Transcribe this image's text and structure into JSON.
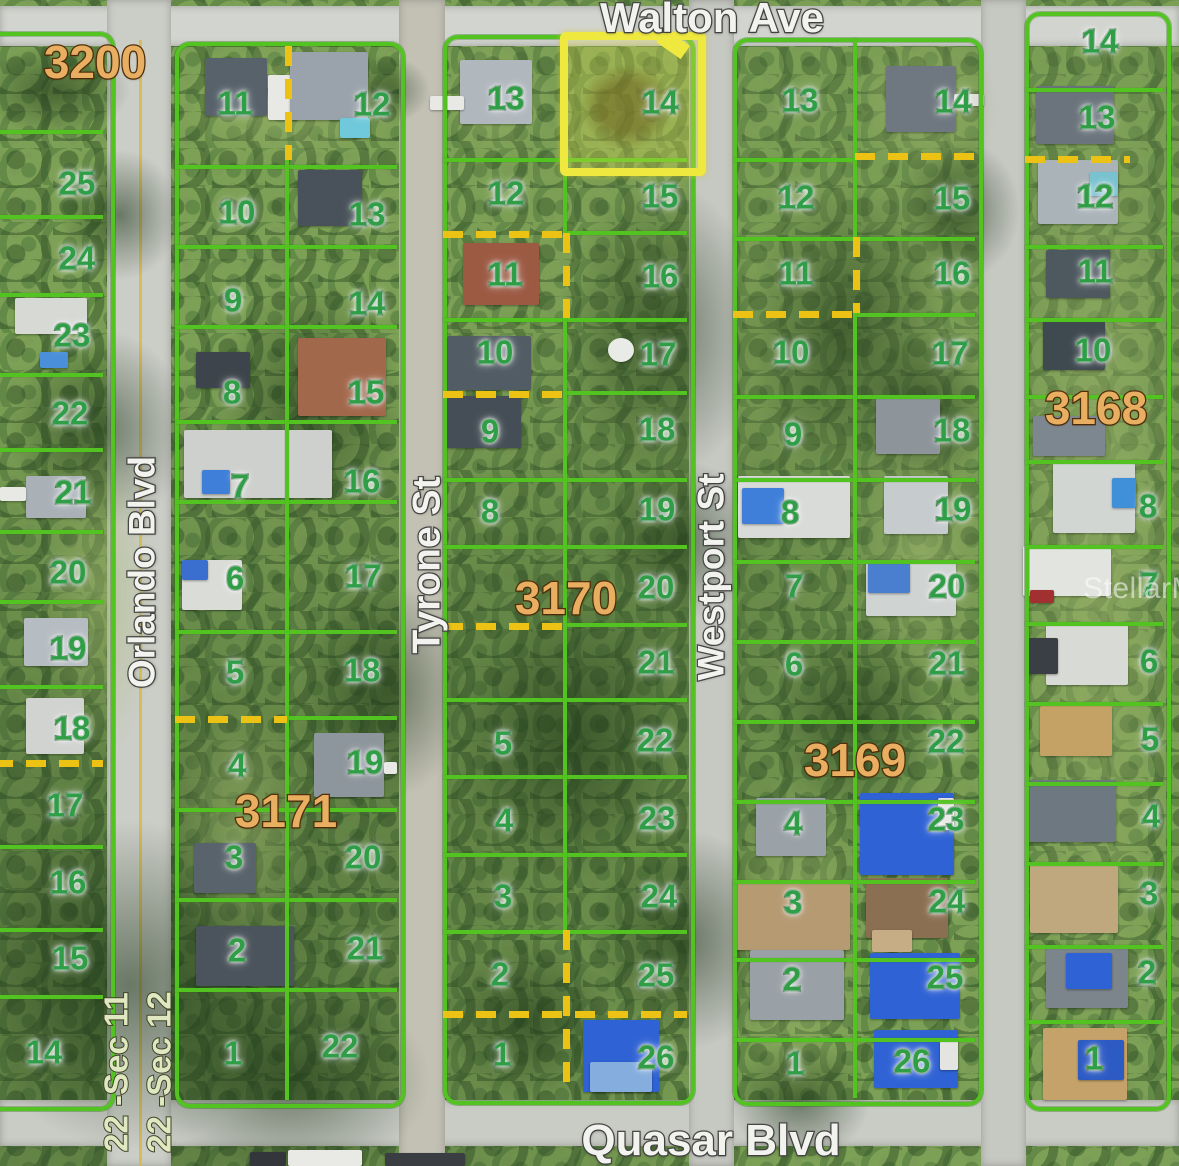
{
  "map": {
    "streets": {
      "top": "Walton Ave",
      "bottom": "Quasar Blvd",
      "left_vertical": "Orlando Blvd",
      "mid_vertical": "Tyrone St",
      "right_vertical": "Westport St"
    },
    "section_labels": [
      "22 -Sec 11",
      "22 -Sec 12"
    ],
    "watermark": "StellarMLS",
    "highlighted_lot": {
      "block": "3170",
      "lot": "14"
    },
    "colors": {
      "lot_line": "#53c322",
      "lot_number": "#2f9e47",
      "block_number": "#e8ae62",
      "highlight": "#efe93f",
      "dashed_line": "#ecc215",
      "road": "#c9cbc5"
    },
    "blocks": [
      {
        "number": "3200",
        "label": {
          "x": 95,
          "y": 62
        },
        "lots": [
          {
            "n": "25",
            "x": 77,
            "y": 183
          },
          {
            "n": "24",
            "x": 77,
            "y": 258
          },
          {
            "n": "23",
            "x": 72,
            "y": 335
          },
          {
            "n": "22",
            "x": 70,
            "y": 413
          },
          {
            "n": "21",
            "x": 73,
            "y": 492
          },
          {
            "n": "20",
            "x": 68,
            "y": 572
          },
          {
            "n": "19",
            "x": 68,
            "y": 648
          },
          {
            "n": "18",
            "x": 72,
            "y": 728
          },
          {
            "n": "17",
            "x": 65,
            "y": 805
          },
          {
            "n": "16",
            "x": 68,
            "y": 882
          },
          {
            "n": "15",
            "x": 70,
            "y": 958
          },
          {
            "n": "14",
            "x": 44,
            "y": 1052
          }
        ]
      },
      {
        "number": "3171",
        "label": {
          "x": 286,
          "y": 811
        },
        "lots": [
          {
            "n": "11",
            "x": 235,
            "y": 103
          },
          {
            "n": "12",
            "x": 372,
            "y": 104
          },
          {
            "n": "10",
            "x": 237,
            "y": 212
          },
          {
            "n": "13",
            "x": 367,
            "y": 214
          },
          {
            "n": "9",
            "x": 233,
            "y": 300
          },
          {
            "n": "14",
            "x": 367,
            "y": 303
          },
          {
            "n": "8",
            "x": 232,
            "y": 392
          },
          {
            "n": "15",
            "x": 366,
            "y": 392
          },
          {
            "n": "7",
            "x": 240,
            "y": 486
          },
          {
            "n": "16",
            "x": 362,
            "y": 481
          },
          {
            "n": "6",
            "x": 235,
            "y": 578
          },
          {
            "n": "17",
            "x": 363,
            "y": 576
          },
          {
            "n": "5",
            "x": 235,
            "y": 672
          },
          {
            "n": "18",
            "x": 362,
            "y": 670
          },
          {
            "n": "4",
            "x": 237,
            "y": 765
          },
          {
            "n": "19",
            "x": 365,
            "y": 762
          },
          {
            "n": "3",
            "x": 234,
            "y": 857
          },
          {
            "n": "20",
            "x": 363,
            "y": 857
          },
          {
            "n": "2",
            "x": 237,
            "y": 950
          },
          {
            "n": "21",
            "x": 365,
            "y": 948
          },
          {
            "n": "1",
            "x": 233,
            "y": 1053
          },
          {
            "n": "22",
            "x": 340,
            "y": 1046
          }
        ]
      },
      {
        "number": "3170",
        "label": {
          "x": 566,
          "y": 598
        },
        "lots": [
          {
            "n": "13",
            "x": 506,
            "y": 98
          },
          {
            "n": "14",
            "x": 660,
            "y": 102,
            "hl": true
          },
          {
            "n": "12",
            "x": 506,
            "y": 193
          },
          {
            "n": "15",
            "x": 660,
            "y": 196
          },
          {
            "n": "11",
            "x": 505,
            "y": 274
          },
          {
            "n": "16",
            "x": 660,
            "y": 276
          },
          {
            "n": "10",
            "x": 495,
            "y": 352
          },
          {
            "n": "17",
            "x": 658,
            "y": 354
          },
          {
            "n": "9",
            "x": 490,
            "y": 431
          },
          {
            "n": "18",
            "x": 657,
            "y": 429
          },
          {
            "n": "8",
            "x": 490,
            "y": 511
          },
          {
            "n": "19",
            "x": 657,
            "y": 509
          },
          {
            "n": "20",
            "x": 656,
            "y": 587
          },
          {
            "n": "21",
            "x": 656,
            "y": 662
          },
          {
            "n": "5",
            "x": 503,
            "y": 743
          },
          {
            "n": "22",
            "x": 655,
            "y": 740
          },
          {
            "n": "4",
            "x": 504,
            "y": 820
          },
          {
            "n": "23",
            "x": 657,
            "y": 818
          },
          {
            "n": "3",
            "x": 503,
            "y": 896
          },
          {
            "n": "24",
            "x": 659,
            "y": 896
          },
          {
            "n": "2",
            "x": 500,
            "y": 974
          },
          {
            "n": "25",
            "x": 656,
            "y": 975
          },
          {
            "n": "1",
            "x": 502,
            "y": 1054
          },
          {
            "n": "26",
            "x": 656,
            "y": 1057
          }
        ]
      },
      {
        "number": "3169",
        "label": {
          "x": 855,
          "y": 760
        },
        "lots": [
          {
            "n": "13",
            "x": 800,
            "y": 100
          },
          {
            "n": "14",
            "x": 953,
            "y": 101
          },
          {
            "n": "12",
            "x": 796,
            "y": 197
          },
          {
            "n": "15",
            "x": 952,
            "y": 198
          },
          {
            "n": "11",
            "x": 796,
            "y": 273
          },
          {
            "n": "16",
            "x": 952,
            "y": 273
          },
          {
            "n": "10",
            "x": 791,
            "y": 352
          },
          {
            "n": "17",
            "x": 950,
            "y": 353
          },
          {
            "n": "9",
            "x": 793,
            "y": 434
          },
          {
            "n": "18",
            "x": 952,
            "y": 430
          },
          {
            "n": "8",
            "x": 790,
            "y": 512
          },
          {
            "n": "19",
            "x": 953,
            "y": 509
          },
          {
            "n": "7",
            "x": 794,
            "y": 586
          },
          {
            "n": "20",
            "x": 947,
            "y": 586
          },
          {
            "n": "6",
            "x": 794,
            "y": 664
          },
          {
            "n": "21",
            "x": 947,
            "y": 663
          },
          {
            "n": "22",
            "x": 946,
            "y": 741
          },
          {
            "n": "4",
            "x": 793,
            "y": 823
          },
          {
            "n": "23",
            "x": 946,
            "y": 819
          },
          {
            "n": "3",
            "x": 793,
            "y": 902
          },
          {
            "n": "24",
            "x": 947,
            "y": 901
          },
          {
            "n": "2",
            "x": 792,
            "y": 979
          },
          {
            "n": "25",
            "x": 945,
            "y": 977
          },
          {
            "n": "1",
            "x": 795,
            "y": 1063
          },
          {
            "n": "26",
            "x": 912,
            "y": 1061
          }
        ]
      },
      {
        "number": "3168",
        "label": {
          "x": 1096,
          "y": 408
        },
        "lots": [
          {
            "n": "14",
            "x": 1100,
            "y": 41
          },
          {
            "n": "13",
            "x": 1097,
            "y": 117
          },
          {
            "n": "12",
            "x": 1095,
            "y": 196
          },
          {
            "n": "11",
            "x": 1095,
            "y": 271
          },
          {
            "n": "10",
            "x": 1093,
            "y": 350
          },
          {
            "n": "8",
            "x": 1148,
            "y": 506
          },
          {
            "n": "7",
            "x": 1149,
            "y": 584
          },
          {
            "n": "6",
            "x": 1149,
            "y": 661
          },
          {
            "n": "5",
            "x": 1150,
            "y": 739
          },
          {
            "n": "4",
            "x": 1151,
            "y": 816
          },
          {
            "n": "3",
            "x": 1149,
            "y": 893
          },
          {
            "n": "2",
            "x": 1147,
            "y": 972
          },
          {
            "n": "1",
            "x": 1094,
            "y": 1058
          }
        ]
      }
    ]
  }
}
